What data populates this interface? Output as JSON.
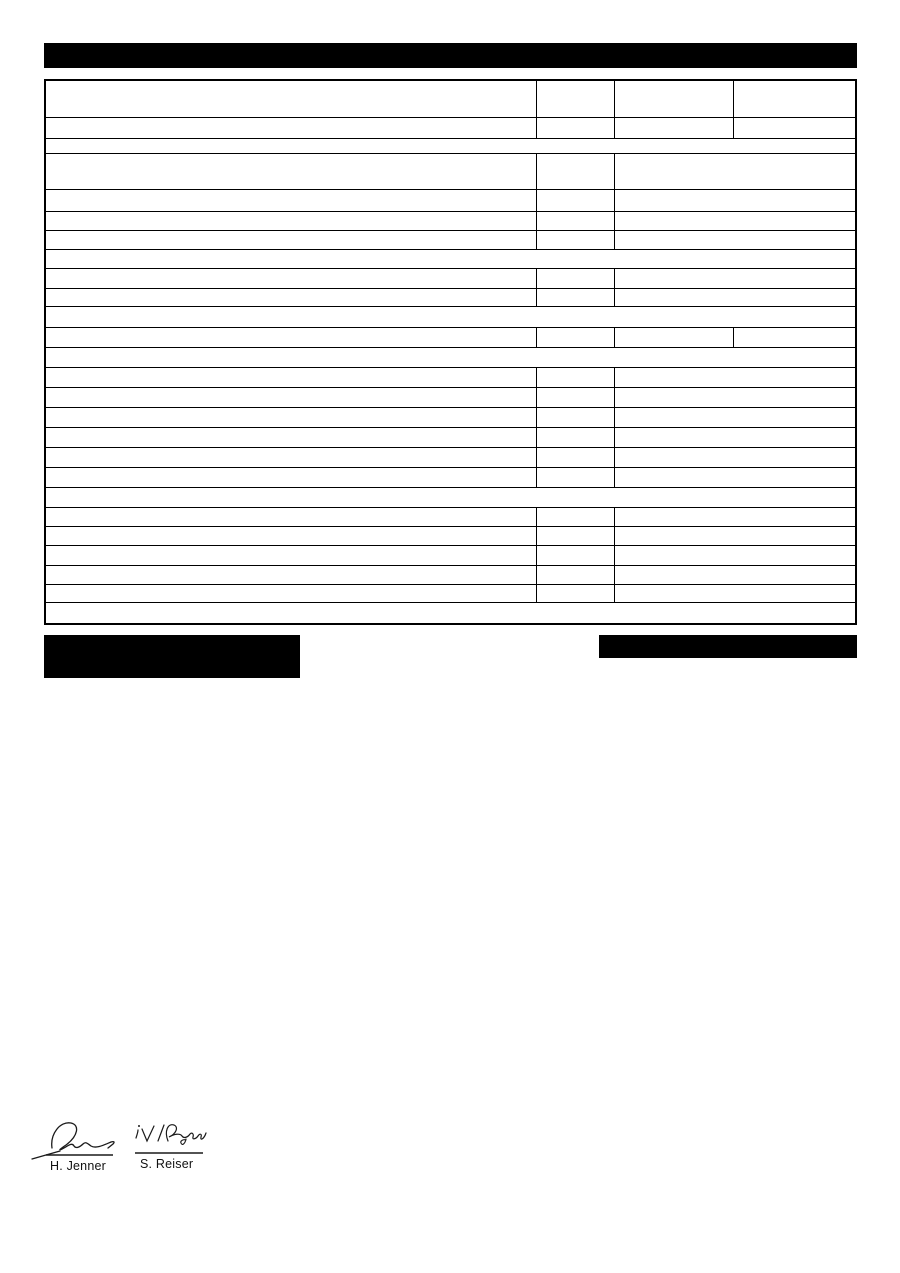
{
  "page": {
    "background": "#ffffff",
    "description": "Blank technical-data form page with redacted header bar, empty specification table, two redacted blocks and two signatures"
  },
  "redactions": {
    "color": "#000000",
    "title_bar": {
      "x": 44,
      "y": 43,
      "width": 813,
      "height": 25
    },
    "left_block": {
      "x": 44,
      "y": 635,
      "width": 256,
      "height": 43
    },
    "right_block": {
      "x": 599,
      "y": 635,
      "width": 258,
      "height": 23
    }
  },
  "table": {
    "line_color": "#000000",
    "background": "#ffffff",
    "columns_pct": [
      60.64,
      9.72,
      14.64,
      15.0
    ],
    "all_cells_empty": true,
    "rows": [
      {
        "h": 37,
        "layout": "cols4"
      },
      {
        "h": 21,
        "layout": "cols4"
      },
      {
        "h": 15,
        "layout": "full"
      },
      {
        "h": 36,
        "layout": "cols3"
      },
      {
        "h": 22,
        "layout": "cols3"
      },
      {
        "h": 19,
        "layout": "cols3"
      },
      {
        "h": 19,
        "layout": "cols3"
      },
      {
        "h": 19,
        "layout": "full"
      },
      {
        "h": 20,
        "layout": "cols3"
      },
      {
        "h": 18,
        "layout": "cols3"
      },
      {
        "h": 21,
        "layout": "full"
      },
      {
        "h": 20,
        "layout": "cols4"
      },
      {
        "h": 20,
        "layout": "full"
      },
      {
        "h": 20,
        "layout": "cols3"
      },
      {
        "h": 20,
        "layout": "cols3"
      },
      {
        "h": 20,
        "layout": "cols3"
      },
      {
        "h": 20,
        "layout": "cols3"
      },
      {
        "h": 20,
        "layout": "cols3"
      },
      {
        "h": 20,
        "layout": "cols3"
      },
      {
        "h": 20,
        "layout": "full"
      },
      {
        "h": 19,
        "layout": "cols3"
      },
      {
        "h": 19,
        "layout": "cols3"
      },
      {
        "h": 20,
        "layout": "cols3"
      },
      {
        "h": 19,
        "layout": "cols3"
      },
      {
        "h": 18,
        "layout": "cols3"
      },
      {
        "h": 20,
        "layout": "full"
      }
    ]
  },
  "signatures": [
    {
      "name": "H. Jenner",
      "handwriting": "illegible scrawl"
    },
    {
      "name": "S. Reiser",
      "handwriting": "i.V. Reiser"
    }
  ],
  "ink_color": "#1a1a1a"
}
